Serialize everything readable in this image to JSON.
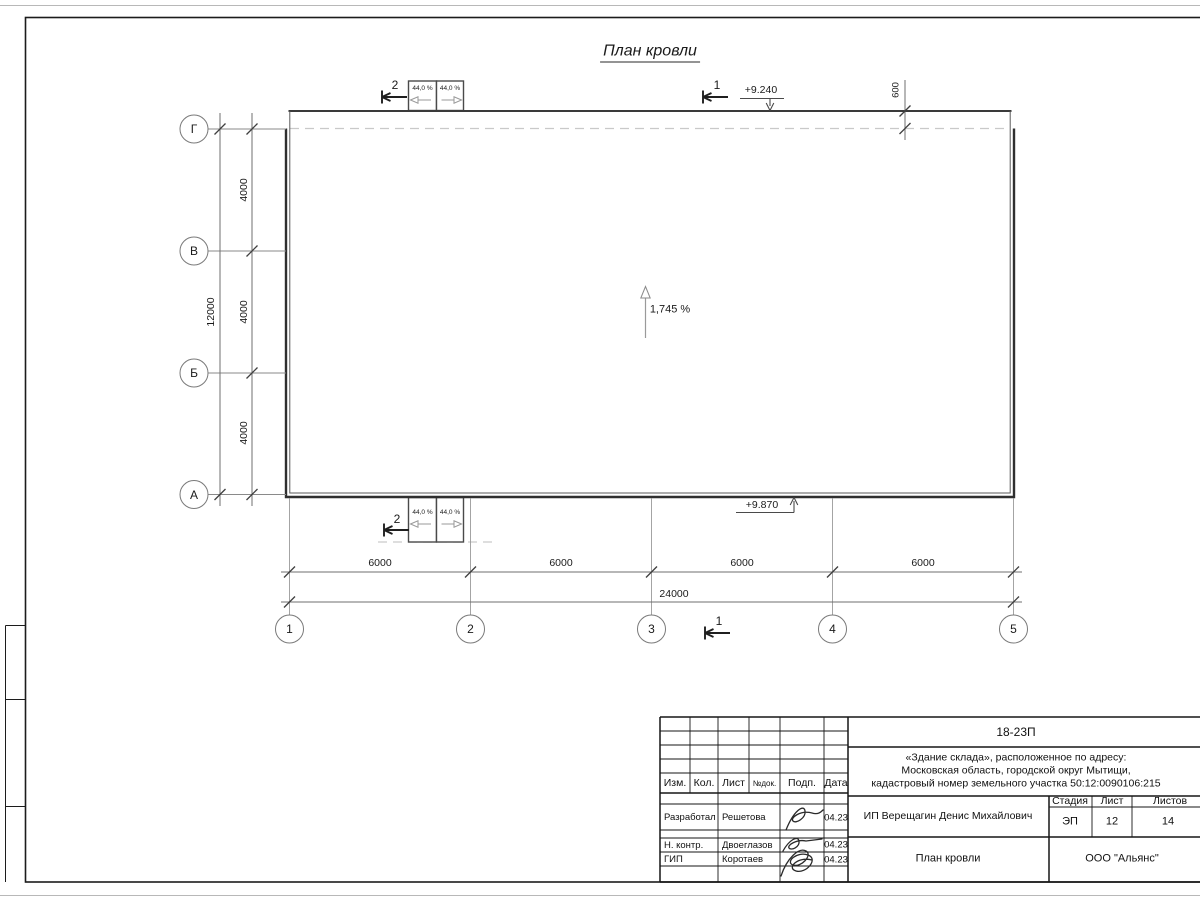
{
  "drawing": {
    "title": "План кровли",
    "slope_main": "1,745 %",
    "slope_canopy": "44,0 %",
    "elev_top": "+9.240",
    "elev_bottom": "+9.870",
    "overhang_dim": "600",
    "section_1": "1",
    "section_2": "2"
  },
  "axes": {
    "rows": [
      "Г",
      "В",
      "Б",
      "А"
    ],
    "cols": [
      "1",
      "2",
      "3",
      "4",
      "5"
    ]
  },
  "dims": {
    "row_step": "4000",
    "row_total": "12000",
    "col_step": "6000",
    "col_total": "24000"
  },
  "title_block": {
    "doc_code": "18-23П",
    "object_address": {
      "line1": "«Здание склада», расположенное по адресу:",
      "line2": "Московская область, городской округ Мытищи,",
      "line3": "кадастровый номер земельного участка 50:12:0090106:215"
    },
    "columns": {
      "izm": "Изм.",
      "kol": "Кол.",
      "list": "Лист",
      "ndok": "№док.",
      "podp": "Подп.",
      "data": "Дата"
    },
    "rows": [
      {
        "role": "Разработал",
        "name": "Решетова",
        "date": "04.23"
      },
      {
        "role": "Н. контр.",
        "name": "Двоеглазов",
        "date": "04.23"
      },
      {
        "role": "ГИП",
        "name": "Коротаев",
        "date": "04.23"
      }
    ],
    "customer": "ИП Верещагин Денис Михайлович",
    "stage_label": "Стадия",
    "sheet_label": "Лист",
    "sheets_label": "Листов",
    "stage": "ЭП",
    "sheet_no": "12",
    "sheets_total": "14",
    "sheet_title": "План кровли",
    "company": "ООО \"Альянс\""
  }
}
